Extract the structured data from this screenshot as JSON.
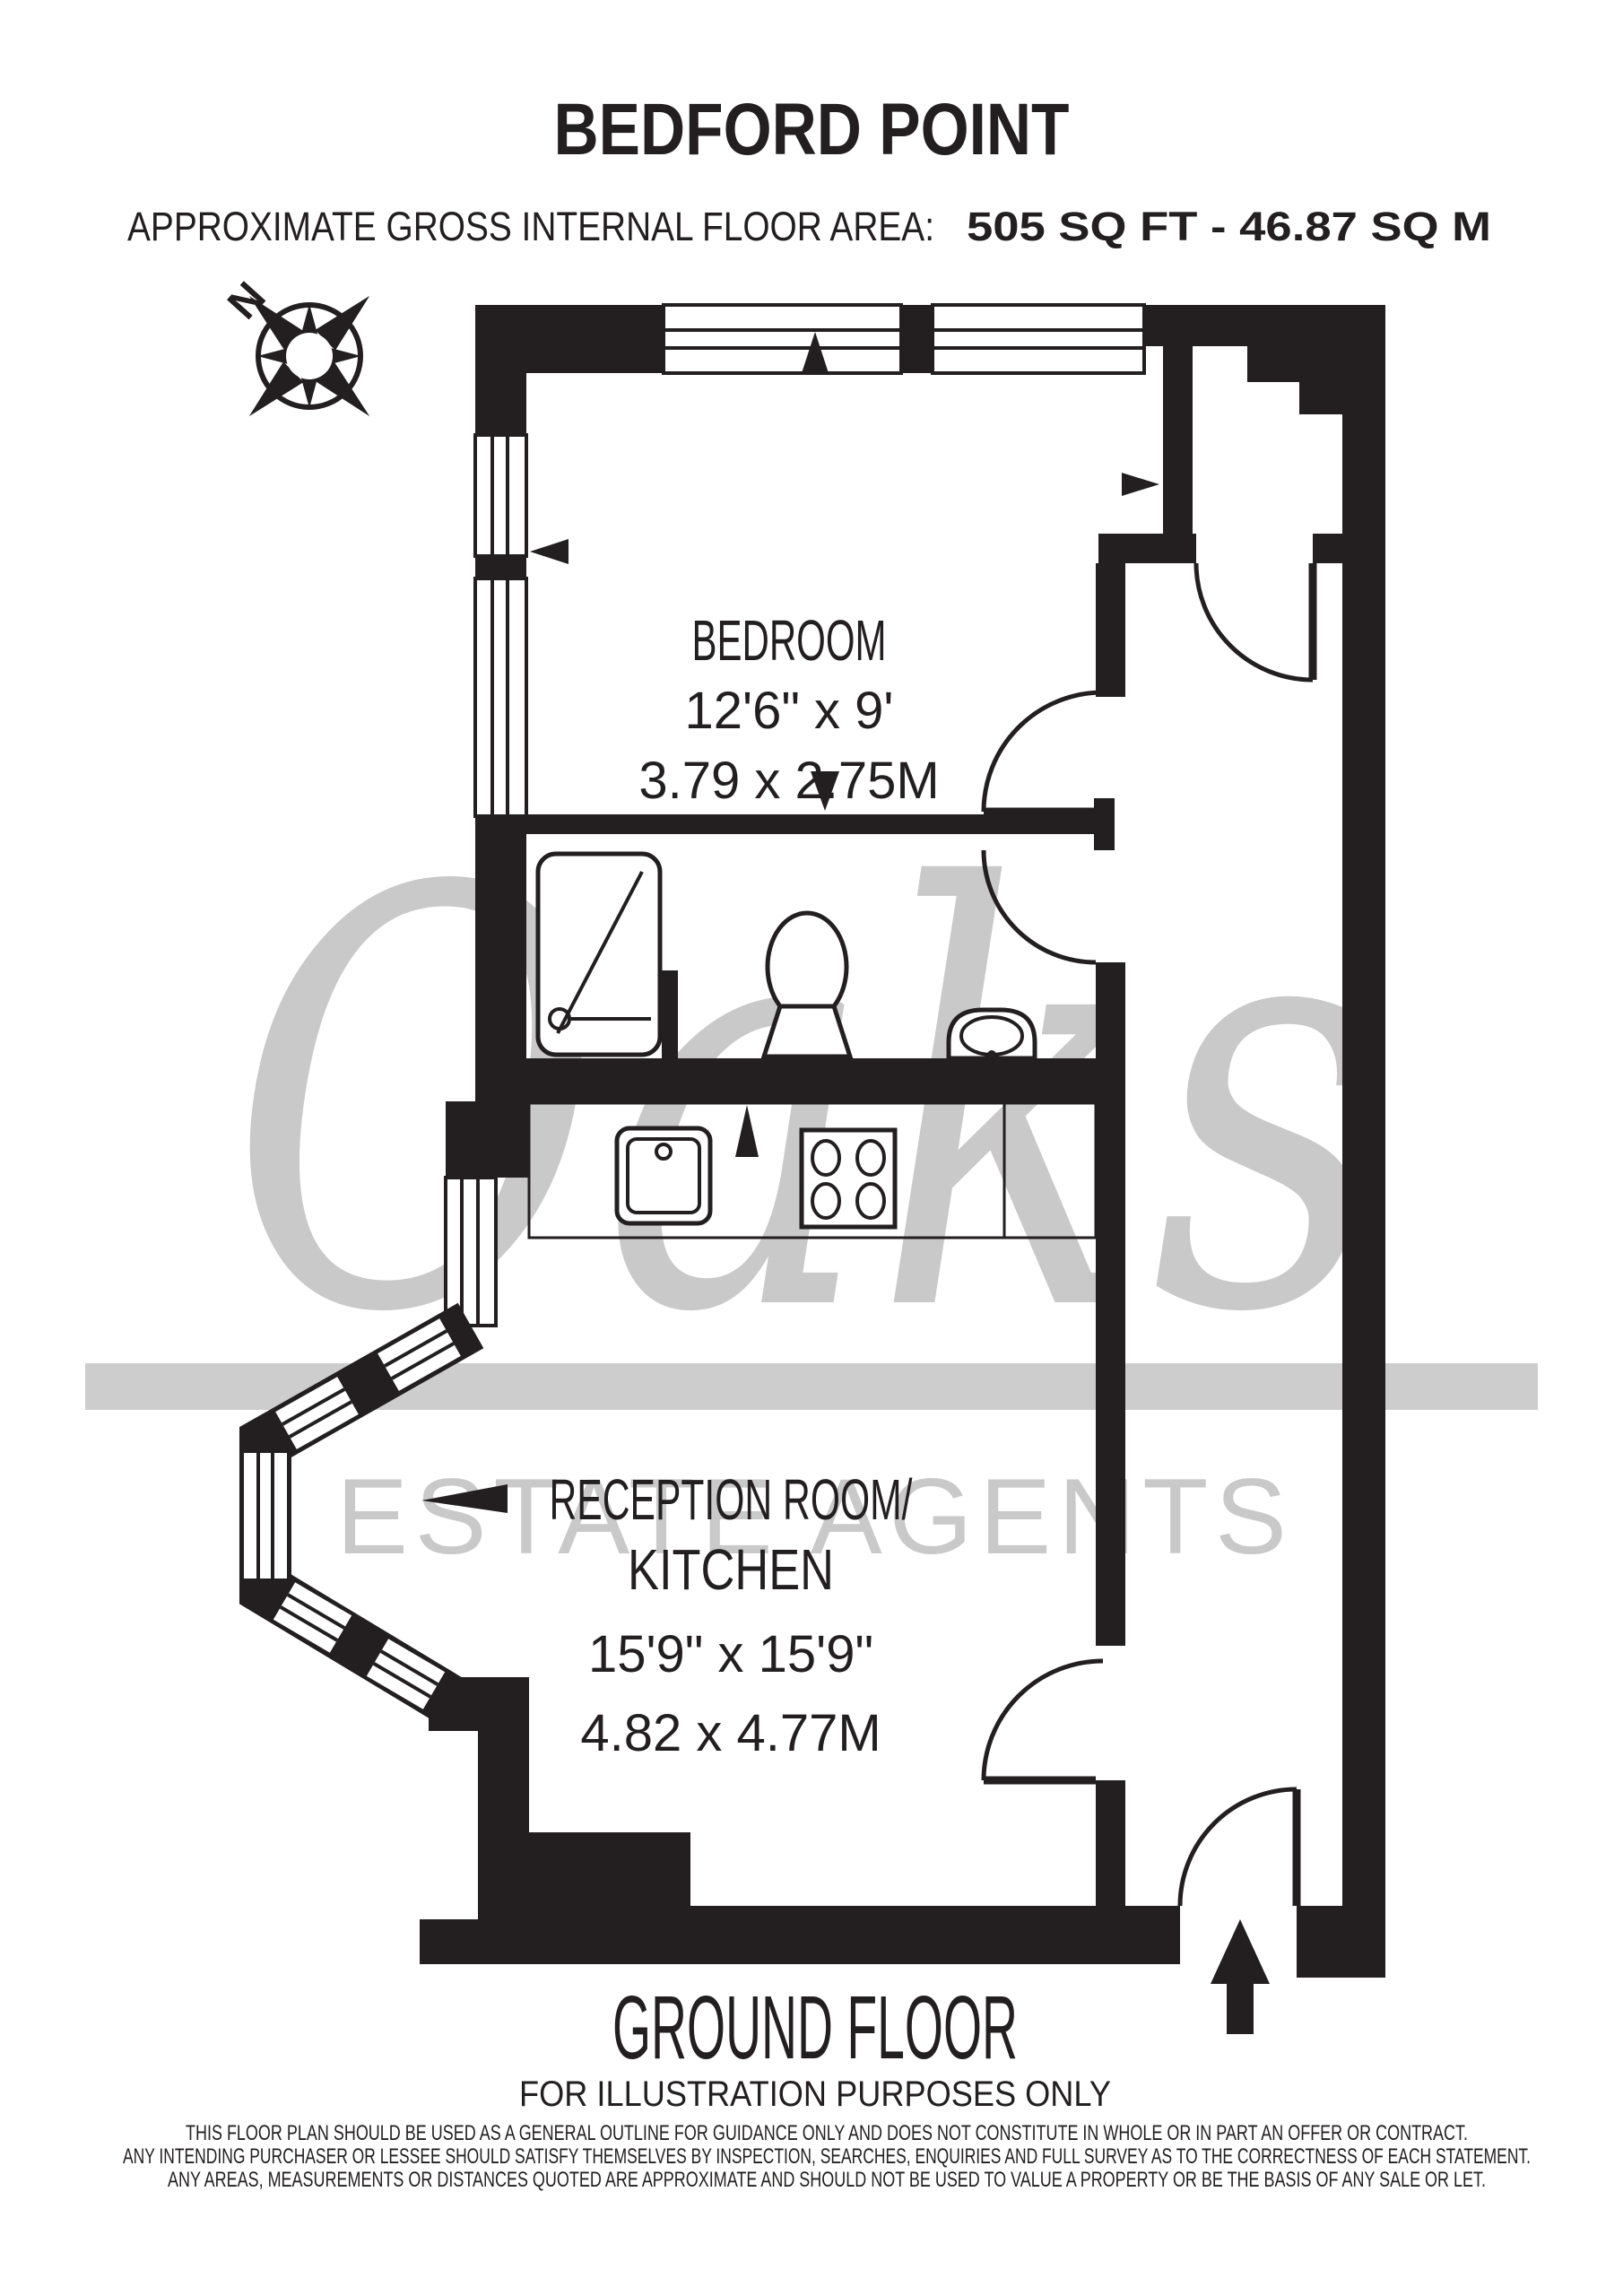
{
  "header": {
    "title": "BEDFORD POINT",
    "area_label": "APPROXIMATE GROSS INTERNAL FLOOR AREA:",
    "area_value": "505 SQ FT  -  46.87 SQ M"
  },
  "compass": {
    "north": "N"
  },
  "rooms": {
    "bedroom": {
      "name": "BEDROOM",
      "imperial": "12'6\" x 9'",
      "metric": "3.79 x 2.75M"
    },
    "reception": {
      "name1": "RECEPTION ROOM/",
      "name2": "KITCHEN",
      "imperial": "15'9\" x 15'9\"",
      "metric": "4.82 x 4.77M"
    }
  },
  "footer": {
    "floor": "GROUND FLOOR",
    "note": "FOR ILLUSTRATION PURPOSES ONLY",
    "disclaimer": [
      "THIS FLOOR PLAN SHOULD BE USED AS A GENERAL OUTLINE FOR GUIDANCE ONLY AND DOES NOT CONSTITUTE IN WHOLE OR IN PART AN OFFER OR CONTRACT.",
      "ANY INTENDING PURCHASER OR LESSEE SHOULD SATISFY THEMSELVES BY INSPECTION, SEARCHES, ENQUIRIES AND FULL SURVEY AS TO THE CORRECTNESS OF EACH STATEMENT.",
      "ANY AREAS, MEASUREMENTS OR DISTANCES QUOTED ARE APPROXIMATE AND SHOULD NOT BE USED TO VALUE A PROPERTY OR BE THE BASIS OF ANY SALE OR LET."
    ]
  },
  "watermark": {
    "brand": "Oaks",
    "tagline": "ESTATE AGENTS"
  },
  "colors": {
    "ink": "#231f20",
    "watermark_gray": "#c9c9c9",
    "band_gray": "#cdcdcd",
    "background": "#ffffff"
  }
}
